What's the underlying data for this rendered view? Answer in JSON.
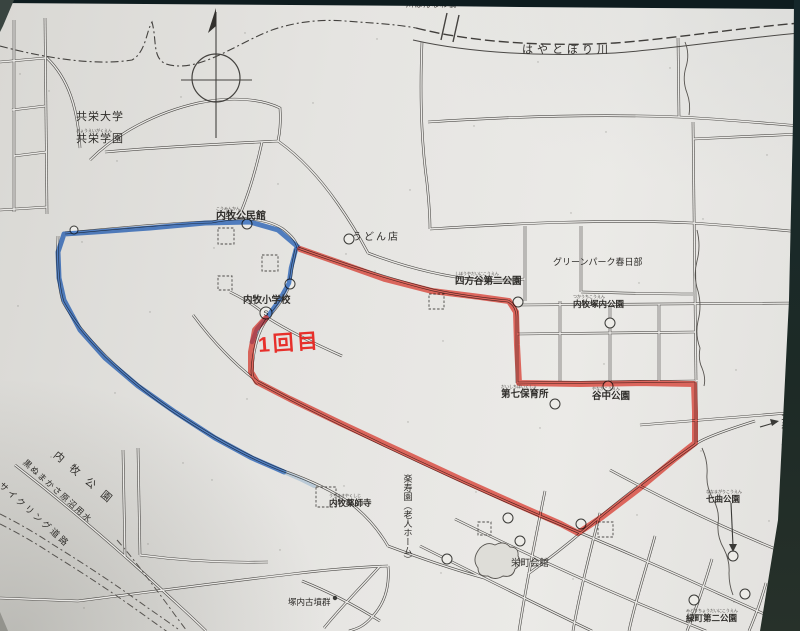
{
  "photo": {
    "paper_color": "#e8e7e4",
    "border_color": "#16282b",
    "road_color": "#4b4946",
    "road_inner": "#eae9e6"
  },
  "note": {
    "text": "1回目",
    "color": "#e8211c"
  },
  "routes": {
    "red": {
      "name": "route-day1-red",
      "color": "#ec392c",
      "width": 6,
      "opacity": 0.72,
      "points": [
        [
          266,
          318
        ],
        [
          255,
          330
        ],
        [
          251,
          352
        ],
        [
          251,
          372
        ],
        [
          257,
          382
        ],
        [
          290,
          399
        ],
        [
          340,
          423
        ],
        [
          400,
          451
        ],
        [
          460,
          479
        ],
        [
          520,
          506
        ],
        [
          561,
          524
        ],
        [
          578,
          533
        ],
        [
          602,
          517
        ],
        [
          640,
          488
        ],
        [
          676,
          458
        ],
        [
          695,
          443
        ],
        [
          695,
          412
        ],
        [
          694,
          384
        ],
        [
          640,
          383
        ],
        [
          580,
          384
        ],
        [
          519,
          383
        ],
        [
          517,
          345
        ],
        [
          516,
          312
        ],
        [
          509,
          301
        ],
        [
          480,
          297
        ],
        [
          432,
          291
        ],
        [
          385,
          279
        ],
        [
          340,
          263
        ],
        [
          300,
          249
        ]
      ]
    },
    "blue_main": {
      "name": "route-blue-west-loop",
      "color": "#2f6fd0",
      "width": 5,
      "opacity": 0.8,
      "points": [
        [
          298,
          247
        ],
        [
          278,
          230
        ],
        [
          250,
          222
        ],
        [
          205,
          223
        ],
        [
          150,
          228
        ],
        [
          95,
          232
        ],
        [
          64,
          234
        ],
        [
          58,
          252
        ],
        [
          59,
          278
        ],
        [
          64,
          300
        ],
        [
          80,
          330
        ],
        [
          105,
          358
        ],
        [
          138,
          386
        ],
        [
          175,
          412
        ],
        [
          215,
          438
        ],
        [
          252,
          458
        ],
        [
          275,
          468
        ],
        [
          284,
          472
        ]
      ]
    },
    "blue_branch": {
      "name": "route-blue-school-branch",
      "color": "#2f6fd0",
      "width": 4.5,
      "opacity": 0.8,
      "points": [
        [
          296,
          249
        ],
        [
          291,
          268
        ],
        [
          289,
          283
        ],
        [
          280,
          299
        ],
        [
          268,
          316
        ],
        [
          257,
          329
        ],
        [
          252,
          342
        ]
      ]
    },
    "blue_tail": {
      "name": "route-blue-faint-tail",
      "color": "#74a8dc",
      "width": 4,
      "opacity": 0.35,
      "points": [
        [
          284,
          472
        ],
        [
          300,
          479
        ],
        [
          314,
          486
        ]
      ]
    }
  },
  "labels": [
    {
      "id": "kyoei-univ",
      "text": "共栄大学",
      "x": 76,
      "y": 112,
      "size": 11,
      "ls": 1
    },
    {
      "id": "kyoei-gakuen",
      "text": "共栄学園",
      "x": 76,
      "y": 129,
      "size": 11,
      "ls": 1,
      "furi": "きょうえいがくえん"
    },
    {
      "id": "hannawa-bridge",
      "text": "川はんなわ橋",
      "x": 406,
      "y": 1,
      "size": 7.5,
      "ls": 1
    },
    {
      "id": "hayatobori-river",
      "text": "はやとぼり川",
      "x": 522,
      "y": 45,
      "size": 11,
      "ls": 4
    },
    {
      "id": "kominkan",
      "text": "内牧公民館",
      "x": 216,
      "y": 207,
      "size": 10,
      "bold": true,
      "furi": "こうみんかん"
    },
    {
      "id": "udon-shop",
      "text": "うどん店",
      "x": 352,
      "y": 233,
      "size": 10,
      "ls": 2
    },
    {
      "id": "greenpark-kasukabe",
      "text": "グリーンパーク春日部",
      "x": 553,
      "y": 258,
      "size": 9
    },
    {
      "id": "shihoya-daini-park",
      "text": "四方谷第二公園",
      "x": 455,
      "y": 272,
      "size": 9.5,
      "bold": true,
      "furi": "しほうやだいにこうえん"
    },
    {
      "id": "tsukauchi-park",
      "text": "内牧塚内公園",
      "x": 573,
      "y": 295,
      "size": 8.5,
      "bold": true,
      "furi": "つかうちこうえん"
    },
    {
      "id": "uchimaki-elementary",
      "text": "内牧小学校",
      "x": 243,
      "y": 296,
      "size": 9.5,
      "bold": true
    },
    {
      "id": "daishichi-nursery",
      "text": "第七保育所",
      "x": 501,
      "y": 385,
      "size": 9.5,
      "bold": true,
      "furi": "だいしちほいくしょ"
    },
    {
      "id": "yanaka-park",
      "text": "谷中公園",
      "x": 592,
      "y": 387,
      "size": 9.5,
      "bold": true,
      "furi": "やなかこうえん"
    },
    {
      "id": "kita-kasukabe-station",
      "text": "北春日部駅",
      "x": 779,
      "y": 412,
      "size": 9.5,
      "vertical": true
    },
    {
      "id": "nanamagari-park",
      "text": "七曲公園",
      "x": 706,
      "y": 490,
      "size": 8.5,
      "bold": true,
      "furi": "ななまがりこうえん"
    },
    {
      "id": "rakujuen-home",
      "text": "楽寿園（老人ホーム）",
      "x": 402,
      "y": 474,
      "size": 9,
      "vertical": true
    },
    {
      "id": "yakushiji-temple",
      "text": "内牧薬師寺",
      "x": 329,
      "y": 494,
      "size": 8.5,
      "bold": true,
      "furi": "うちまきやくしじ"
    },
    {
      "id": "sakaecho-hall",
      "text": "栄町会館",
      "x": 511,
      "y": 559,
      "size": 9.5
    },
    {
      "id": "kofun-group",
      "text": "塚内古墳群",
      "x": 288,
      "y": 598,
      "size": 8.5
    },
    {
      "id": "midoricho-daini-park",
      "text": "緑町第二公園",
      "x": 686,
      "y": 609,
      "size": 8.5,
      "bold": true,
      "furi": "みどりちょうだいにこうえん"
    },
    {
      "id": "uchimaki-park",
      "text": "内牧公園",
      "x": 58,
      "y": 450,
      "size": 10.5,
      "ls": 10,
      "rot": 40
    },
    {
      "id": "kuronuma-canal",
      "text": "黒ぬまかさ原沼用水",
      "x": 27,
      "y": 458,
      "size": 8.5,
      "ls": 1.5,
      "rot": 42
    },
    {
      "id": "cycling-road",
      "text": "サイクリング道路",
      "x": 3,
      "y": 481,
      "size": 9,
      "ls": 2.5,
      "rot": 42
    }
  ],
  "map": {
    "roads": [
      "M14,20 L14,212",
      "M45,18 L47,214",
      "M0,62 L45,58",
      "M12,110 L45,106",
      "M14,156 L46,152",
      "M0,210 L47,207",
      "M47,58 C68,78 78,108 80,148",
      "M105,152 C160,147 220,144 278,141",
      "M90,160 C118,132 158,112 198,103 C232,96 262,99 280,108 C281,122 280,132 278,141",
      "M262,142 C257,165 250,190 241,212",
      "M212,222 C240,216 266,218 283,229 C292,236 296,241 298,248",
      "M65,233 C120,228 170,223 212,222",
      "M58,236 C57,262 58,286 63,302",
      "M63,302 C82,336 122,376 170,409 C210,436 250,458 284,471",
      "M284,471 C312,481 333,491 350,503 C366,515 378,529 388,546",
      "M278,141 C302,158 322,181 338,204 C350,221 360,238 368,253",
      "M368,253 C402,266 440,276 478,280 C497,281 512,280 525,279",
      "M298,248 C340,263 386,278 433,290 C461,296 486,299 508,301",
      "M508,301 C514,304 517,309 517,317 L517,383",
      "M517,383 L696,381",
      "M696,381 L696,444",
      "M193,315 C217,347 238,367 258,382 C330,421 440,473 540,516 C600,541 652,563 702,586 C740,603 772,617 800,631",
      "M268,318 C258,330 253,351 252,371 C252,377 254,381 258,384",
      "M296,249 C293,262 291,272 290,284 C286,296 277,307 268,318",
      "M230,292 C248,301 262,310 268,318 C290,332 315,344 342,356",
      "M525,226 L525,301",
      "M581,226 L581,292",
      "M581,292 C620,293 658,294 693,294",
      "M430,229 C520,223 610,219 692,223 C735,226 770,229 800,232",
      "M428,122 C520,116 600,114 678,117 C722,119 762,123 800,126",
      "M422,42 C420,90 421,140 427,183 C429,202 430,216 430,229",
      "M678,38 L679,117",
      "M693,122 L696,380",
      "M693,139 L800,134",
      "M560,301 L560,381",
      "M610,303 L610,381",
      "M659,304 L659,381",
      "M517,334 L696,332",
      "M517,305 L800,303",
      "M640,425 L800,412",
      "M755,421 C720,432 702,439 696,444 C660,469 622,498 583,531 C563,548 546,561 528,574",
      "M610,470 C680,508 742,536 800,559",
      "M455,519 C540,561 630,601 706,631",
      "M420,546 C490,581 558,615 592,631",
      "M545,491 C535,540 526,586 519,631",
      "M600,513 C589,556 579,596 573,631",
      "M655,536 C644,576 635,602 629,631",
      "M712,559 C701,596 693,616 687,631",
      "M766,583 C758,611 753,621 749,631",
      "M0,598 L78,601",
      "M78,601 C150,592 222,582 292,574 C325,570 356,567 388,566",
      "M388,546 C420,558 452,569 484,578",
      "M388,566 C390,588 384,605 371,618 C363,627 356,629 349,631",
      "M302,581 C332,593 356,606 380,621",
      "M380,566 C362,586 342,606 324,628",
      "M123,450 L125,557",
      "M138,448 L140,555",
      "M140,555 C185,561 228,563 268,562",
      "M15,465 C60,500 112,544 160,588 C176,603 192,617 206,631"
    ],
    "boundaries": [
      "M0,46 C45,58 95,66 132,60 C146,52 146,32 152,22 C157,40 152,58 166,64 C198,74 235,44 272,30 C295,22 320,19 345,21 C370,23 395,24 416,28"
    ],
    "river_dashed": "M416,28 C470,42 545,47 615,43 C670,39 730,29 800,23",
    "river_solid": "M413,40 C470,53 545,57 615,53 C672,49 732,39 800,33",
    "bridge_ticks": [
      "M447,13 L441,40",
      "M459,15 L453,42"
    ],
    "streams": [
      "M685,42 q5,12 1,25 q-4,13 1,26 q4,11 2,22",
      "M697,230 q4,16 0,31 q-4,15 1,30 q4,15 0,30 q-3,14 2,27 q-2,12 2,20 q4,10 2,18",
      "M702,448 q6,13 5,26 q-1,13 6,25 q7,12 5,25 q-1,13 6,25 q6,12 5,24 q0,12 4,22"
    ],
    "streams_dashed": [
      "M0,524 q28,14 52,30 q26,16 50,32 q24,16 46,32 q14,10 28,20",
      "M0,514 q28,14 52,30 q26,16 50,32 q24,16 46,32 q16,11 30,21",
      "M117,540 q14,16 26,32 q12,16 24,32 q10,14 20,27"
    ],
    "circles": [
      [
        74,
        230,
        4
      ],
      [
        247,
        224,
        5
      ],
      [
        290,
        284,
        5
      ],
      [
        349,
        239,
        5
      ],
      [
        518,
        302,
        5
      ],
      [
        610,
        323,
        5
      ],
      [
        555,
        404,
        5
      ],
      [
        608,
        386,
        5
      ],
      [
        508,
        518,
        5
      ],
      [
        520,
        541,
        5
      ],
      [
        447,
        559,
        5
      ],
      [
        581,
        524,
        5
      ],
      [
        733,
        556,
        5
      ],
      [
        745,
        594,
        5
      ],
      [
        694,
        600,
        5
      ]
    ],
    "school_circle": {
      "x": 266,
      "y": 313,
      "r": 6,
      "glyph": "S"
    },
    "dots": [
      [
        335,
        598,
        2.2
      ]
    ],
    "squares": [
      [
        218,
        228,
        16
      ],
      [
        262,
        255,
        16
      ],
      [
        218,
        276,
        14
      ],
      [
        429,
        294,
        15
      ],
      [
        316,
        487,
        20
      ],
      [
        478,
        522,
        13
      ],
      [
        598,
        522,
        15
      ]
    ],
    "blobs": [
      "M480,548 q7,-7 15,-3 q9,-5 15,2 q9,0 8,9 q5,8 -3,13 q-2,9 -12,7 q-8,5 -15,0 q-10,1 -10,-8 q-7,-9 2,-20 z"
    ],
    "arrows": [
      {
        "name": "station-arrow",
        "line": "M760,427 L777,422",
        "head": "779,421 770,419 772,426"
      },
      {
        "name": "nanamagari-arrow",
        "line": "M731,503 L733,546",
        "head": "733,552 729,544 737,544"
      }
    ],
    "north": {
      "cx": 216,
      "cy": 78,
      "r": 24,
      "v": [
        216,
        12,
        216,
        138
      ],
      "h": [
        181,
        80,
        252,
        80
      ],
      "needle": "216,8 208,33 216,26"
    }
  }
}
